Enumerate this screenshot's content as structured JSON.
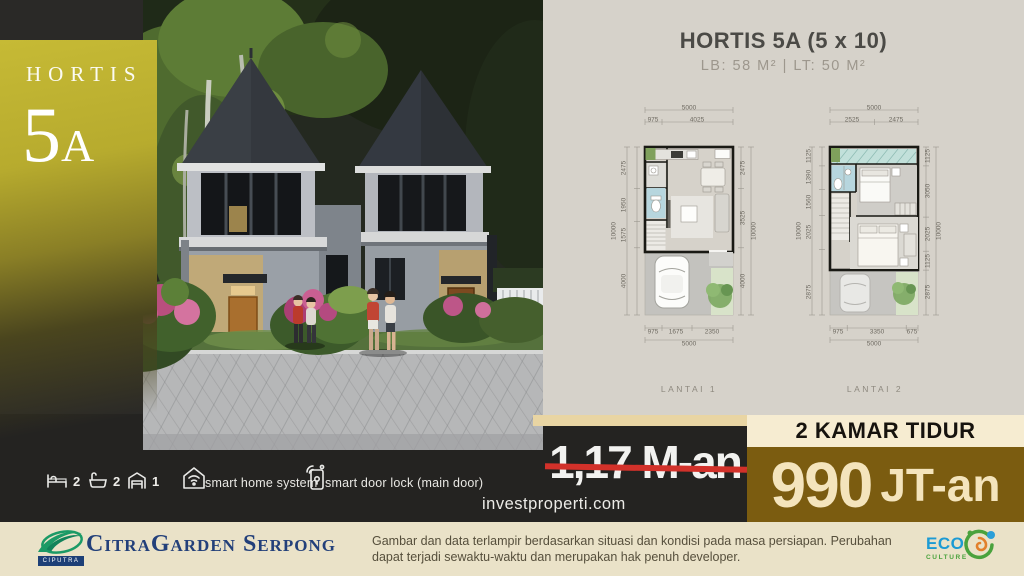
{
  "badge": {
    "line1": "HORTIS",
    "number": "5",
    "letter": "A"
  },
  "plan_panel": {
    "title": "HORTIS 5A (5 x 10)",
    "subtitle": "LB: 58 M²  |  LT: 50 M²",
    "plans": [
      {
        "caption": "LANTAI 1",
        "top_total": "5000",
        "top_segs": [
          "975",
          "4025"
        ],
        "bottom_segs": [
          "975",
          "1675",
          "2350"
        ],
        "bottom_total": "5000",
        "left_segs": [
          "2475",
          "1950",
          "1575",
          "4000"
        ],
        "left_total": "10000",
        "right_segs": [
          "2475",
          "3525",
          "4000"
        ],
        "right_total": "10000"
      },
      {
        "caption": "LANTAI 2",
        "top_total": "5000",
        "top_segs": [
          "2525",
          "2475"
        ],
        "bottom_segs": [
          "975",
          "3350",
          "675"
        ],
        "bottom_total": "5000",
        "left_segs": [
          "1125",
          "1390",
          "1560",
          "2025",
          "2875"
        ],
        "left_total": "10000",
        "right_segs": [
          "1125",
          "3050",
          "2025",
          "1125",
          "2875"
        ],
        "right_total": "10000"
      }
    ]
  },
  "features": {
    "bedrooms": "2",
    "bathrooms": "2",
    "carport": "1",
    "smart_home_label": "smart home system",
    "smart_lock_label": "smart door lock (main door)"
  },
  "website": "investproperti.com",
  "offer": {
    "old_price": "1,17 M-an",
    "banner": "2 KAMAR TIDUR",
    "price_value": "990",
    "price_unit": "JT-an"
  },
  "footer": {
    "ciputra": "CIPUTRA",
    "developer": "CitraGarden Serpong",
    "disclaimer": "Gambar dan data terlampir berdasarkan situasi dan kondisi pada masa persiapan. Perubahan dapat terjadi sewaktu-waktu dan merupakan hak penuh developer.",
    "eco_line1": "ECO",
    "eco_line2": "CULTURE"
  },
  "colors": {
    "gold": "#bfb32e",
    "brown": "#7b5c10",
    "cream": "#f6ecd1",
    "strike_red": "#d2312a",
    "navy": "#23407a",
    "eco_blue": "#1d9bd4",
    "eco_green": "#4aa23d"
  }
}
